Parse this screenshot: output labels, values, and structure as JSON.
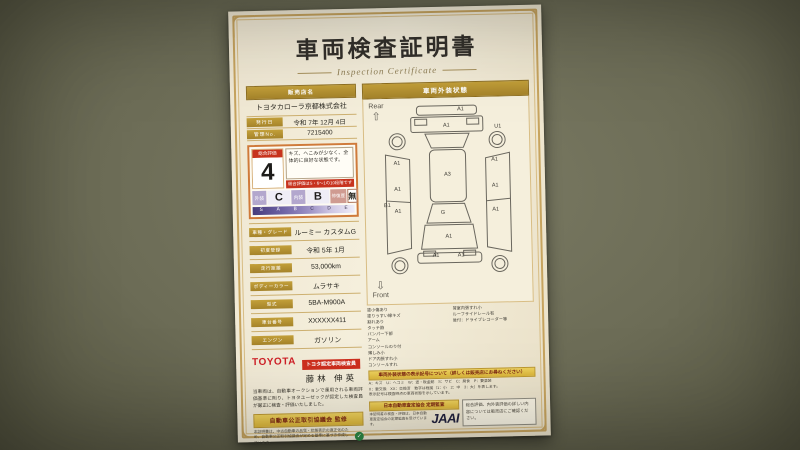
{
  "certificate": {
    "title": "車両検査証明書",
    "subtitle": "Inspection Certificate"
  },
  "dealer": {
    "name_label": "販売店名",
    "name": "トヨタカローラ京都株式会社",
    "issue_date_label": "発行日",
    "issue_date": "令和 7年 12月 4日",
    "control_no_label": "管理No.",
    "control_no": "7215400"
  },
  "evaluation": {
    "overall_label": "総合評価",
    "overall_score": "4",
    "comment": "キズ、へこみが少なく、全体的に良好な状態です。",
    "banner": "総合評価はS・6〜1の10段階です",
    "exterior_label": "外装",
    "exterior_grade": "C",
    "interior_label": "内装",
    "interior_grade": "B",
    "repair_label": "修復歴",
    "repair_value": "無",
    "scale_letters": [
      "S",
      "A",
      "B",
      "C",
      "D",
      "E"
    ]
  },
  "details": {
    "rows": [
      {
        "label": "車種・グレード",
        "value": "ルーミー カスタムG"
      },
      {
        "label": "初度登録",
        "value": "令和 5年 1月"
      },
      {
        "label": "走行距離",
        "value": "53,000km"
      },
      {
        "label": "ボディーカラー",
        "value": "ムラサキ"
      },
      {
        "label": "型式",
        "value": "5BA-M900A"
      },
      {
        "label": "車台番号",
        "value": "XXXXXX411"
      },
      {
        "label": "エンジン",
        "value": "ガソリン"
      }
    ]
  },
  "inspector": {
    "brand": "TOYOTA",
    "badge": "トヨタ認定車両検査員",
    "name": "藤林 伸英",
    "statement": "当車両は、自動車オークションで運用される車両評価基準に則り、トヨタユーゼックが認定した検査員が厳正に検査・評価いたしました。"
  },
  "fair_trade": {
    "band": "自動車公正取引協議会 監修",
    "note": "本証明書は、中古自動車の品質・状態表示の適正化のため、自動車公正取引協議会が定める基準に基づき作成しています。",
    "mark": "✓"
  },
  "exterior_panel": {
    "header": "車両外装状態",
    "rear_label": "Rear",
    "rear_arrow": "⇧",
    "front_label": "Front",
    "front_arrow": "⇩",
    "marks": [
      {
        "label": "A1",
        "x": 61,
        "y": 4
      },
      {
        "label": "A1",
        "x": 50,
        "y": 12
      },
      {
        "label": "U1",
        "x": 89,
        "y": 13
      },
      {
        "label": "A1",
        "x": 12,
        "y": 31
      },
      {
        "label": "A1",
        "x": 86,
        "y": 30
      },
      {
        "label": "A3",
        "x": 50,
        "y": 37
      },
      {
        "label": "A1",
        "x": 12,
        "y": 44
      },
      {
        "label": "B1",
        "x": 4,
        "y": 52
      },
      {
        "label": "A1",
        "x": 12,
        "y": 55
      },
      {
        "label": "A1",
        "x": 86,
        "y": 43
      },
      {
        "label": "A1",
        "x": 86,
        "y": 55
      },
      {
        "label": "G",
        "x": 46,
        "y": 56
      },
      {
        "label": "A1",
        "x": 50,
        "y": 68
      },
      {
        "label": "A1",
        "x": 40,
        "y": 78
      },
      {
        "label": "A1",
        "x": 59,
        "y": 78
      }
    ]
  },
  "notes": {
    "left": [
      "塗小傷あり",
      "塗りうすい線キズ",
      "割れあり",
      "タッチ跡",
      "バンパー下部",
      "アーム",
      "コンソールのり付",
      "薄しみ小",
      "ドア内張すれ小",
      "コンソールすれ"
    ],
    "right": [
      "荷室内張すれ小",
      "ルーフサイドレール有",
      "後付：ドライブレコーダー等"
    ]
  },
  "symbol_legend": {
    "band": "車両外装状態の表示記号について（詳しくは販売店にお尋ねください）",
    "lines": [
      "A：キズ　U：ヘコミ　W：波・板金跡　S：サビ　C：腐食　P：要塗装",
      "X：要交換　XX：交換済　数字は程度（1：小　2：中　3：大）を表します。",
      "表示記号は検査時点の車両状態を示しています。"
    ]
  },
  "assessor": {
    "band": "日本自動車査定協会 定期監査",
    "note": "本証明書の検査・評価は、日本自動車査定協会の定期監査を受けています。",
    "logo": "JAAI",
    "box_text": "総合評価、内外装評価の詳しい内容については販売店にご確認ください。"
  }
}
